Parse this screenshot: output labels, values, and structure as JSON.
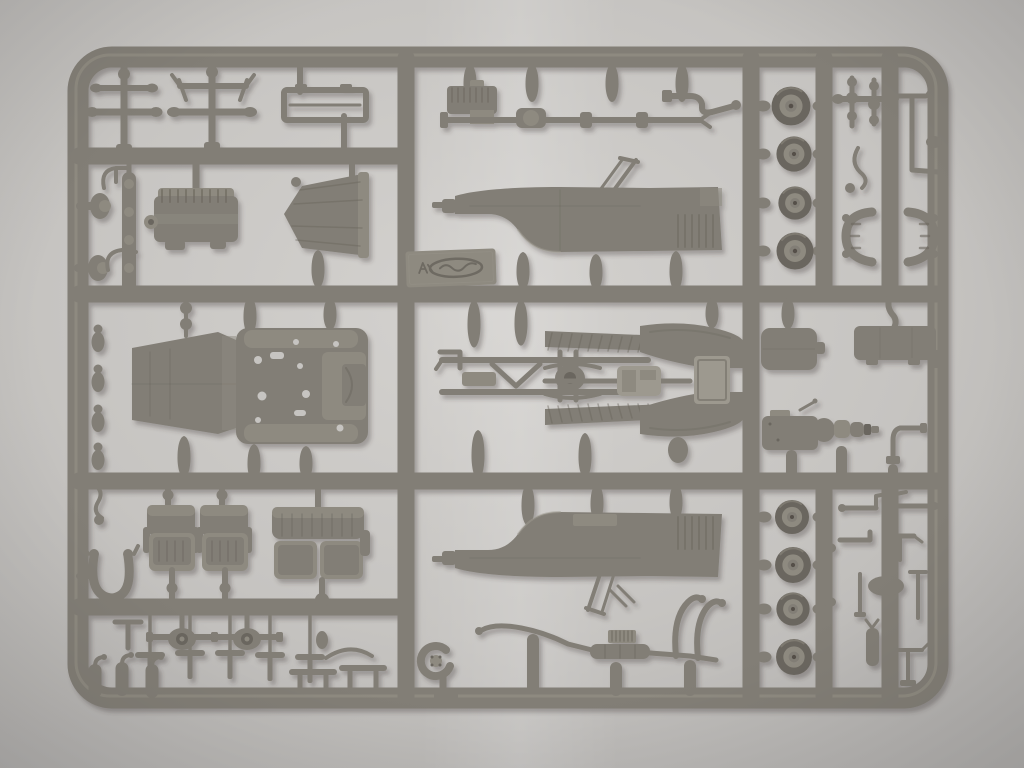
{
  "scene": {
    "type": "photograph",
    "subject": "Plastic scale-model kit sprue (injection-molded runner) with unassembled staff-car parts, photographed on a plain light-grey backdrop",
    "plastic_finish": "matte grey-olive styrene",
    "palette": {
      "bg_center": "#d4d2cf",
      "bg_mid": "#c6c4c1",
      "bg_edge": "#b0aeac",
      "plastic_base": "#827e76",
      "plastic_light": "#9d998f",
      "plastic_mid": "#8e8a80",
      "plastic_dark": "#6a665e",
      "plastic_shadow": "#544f48",
      "emboss": "#6e6a62",
      "shadow_cast": "#3a3731"
    },
    "counts": {
      "wheels": 8,
      "bucket_seats": 2,
      "bench_seats": 1,
      "body_side_panels": 2
    },
    "parts": {
      "frame": "Sprue frame and runners",
      "suspension_cross_a": "Axle unit with kingpins",
      "suspension_cross_b": "Axle unit with swing arms",
      "roof_frame": "Folded canvas-top frame",
      "engine_block": "Ribbed engine block",
      "cone_housing": "Bell-shaped housing",
      "leaf_spring": "Leaf spring",
      "spring_knobs": "Spring shackles",
      "hooks": "Mounting brackets",
      "floor_pan": "Body floor pan with locating holes",
      "shock_bulbs": "Shock-absorber bodies",
      "bucket_seat": "Bucket seat",
      "bench_seat": "Rear bench seat",
      "horseshoe": "Spare-wheel bracket",
      "axle_diff": "Axle with differential housing",
      "t_levers": "Pedal and lever set",
      "bottles": "Canister set",
      "tables": "Foot boards",
      "engine_drivetrain": "Engine with driveshaft",
      "bent_axle": "Steering linkage",
      "body_side_upper": "Body side panel, left",
      "body_side_lower": "Body side panel, right",
      "logo_plate": "Embossed manufacturer plate (mirrored, illegible)",
      "chassis_mid": "Chassis with suspension, fenders and running boards",
      "exhaust": "Exhaust pipe with muffler",
      "spiral_part": "Coiled horn part",
      "hook_pipes": "Exhaust down-pipes",
      "wheels_top": "Road wheels, upper set of four",
      "wheels_bottom": "Road wheels, lower set of four",
      "knob_totems": "Crankshaft and column parts",
      "l_bracket": "Frame bracket",
      "curved_lever": "Gear lever",
      "cage": "Radiator shell halves",
      "fuel_tank": "Fuel tank",
      "storage_box": "Stowage box with filler pipe",
      "transmission": "Transmission with clutch bell",
      "pipe_part": "Filler pipe",
      "small_fittings": "Small fittings: links, levers, brackets"
    }
  }
}
